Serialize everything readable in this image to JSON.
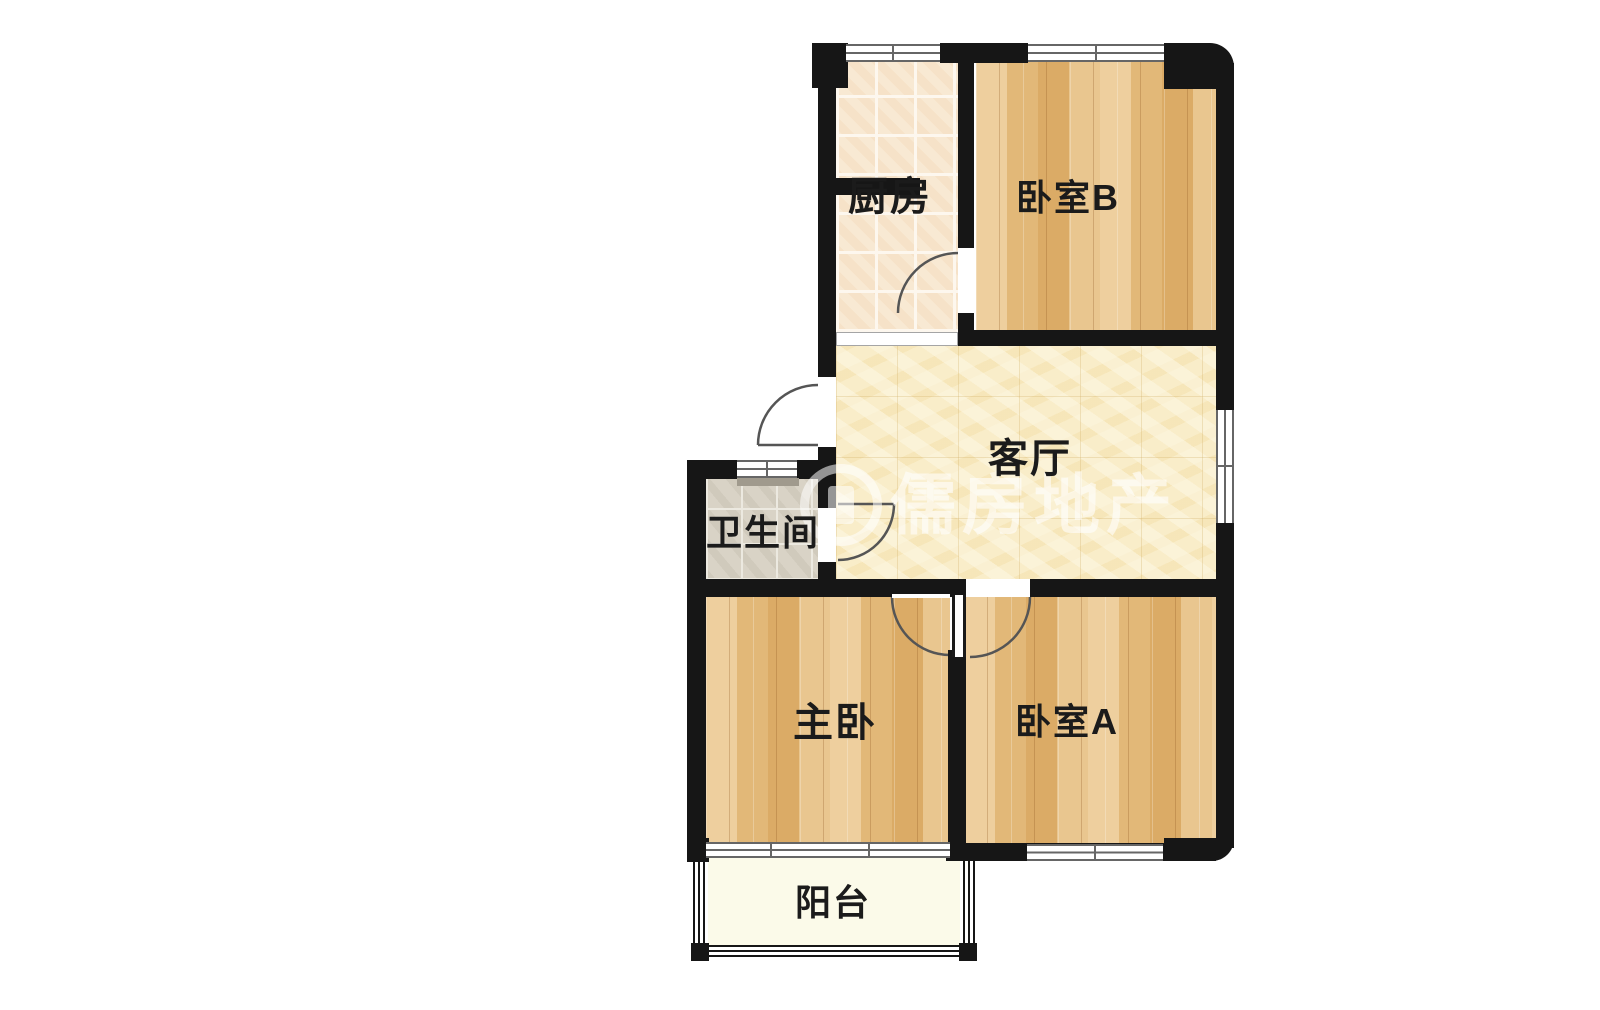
{
  "page": {
    "background": "#ffffff",
    "type": "apartment-floorplan"
  },
  "watermark": {
    "text": "儒房地产",
    "logo": "rufang-circle-logo",
    "color": "rgba(255,255,255,0.58)"
  },
  "rooms": [
    {
      "id": "kitchen",
      "label": "厨房",
      "floor_type": "ceramic-tile-peach"
    },
    {
      "id": "bedroom-b",
      "label": "卧室B",
      "floor_type": "wood-plank"
    },
    {
      "id": "living-room",
      "label": "客厅",
      "floor_type": "tile-pale-yellow"
    },
    {
      "id": "bathroom",
      "label": "卫生间",
      "floor_type": "tile-gray"
    },
    {
      "id": "master-bedroom",
      "label": "主卧",
      "floor_type": "wood-plank"
    },
    {
      "id": "bedroom-a",
      "label": "卧室A",
      "floor_type": "wood-plank"
    },
    {
      "id": "balcony",
      "label": "阳台",
      "floor_type": "plain-cream"
    }
  ],
  "colors": {
    "wall": "#161616",
    "wood_floor": "#e7c28a",
    "kitchen_tile": "#f8e9d3",
    "living_tile": "#f9edc9",
    "bath_tile": "#d9d3c6",
    "balcony_floor": "#fbfae9",
    "door_arc": "#555555",
    "window_line": "#666666"
  }
}
